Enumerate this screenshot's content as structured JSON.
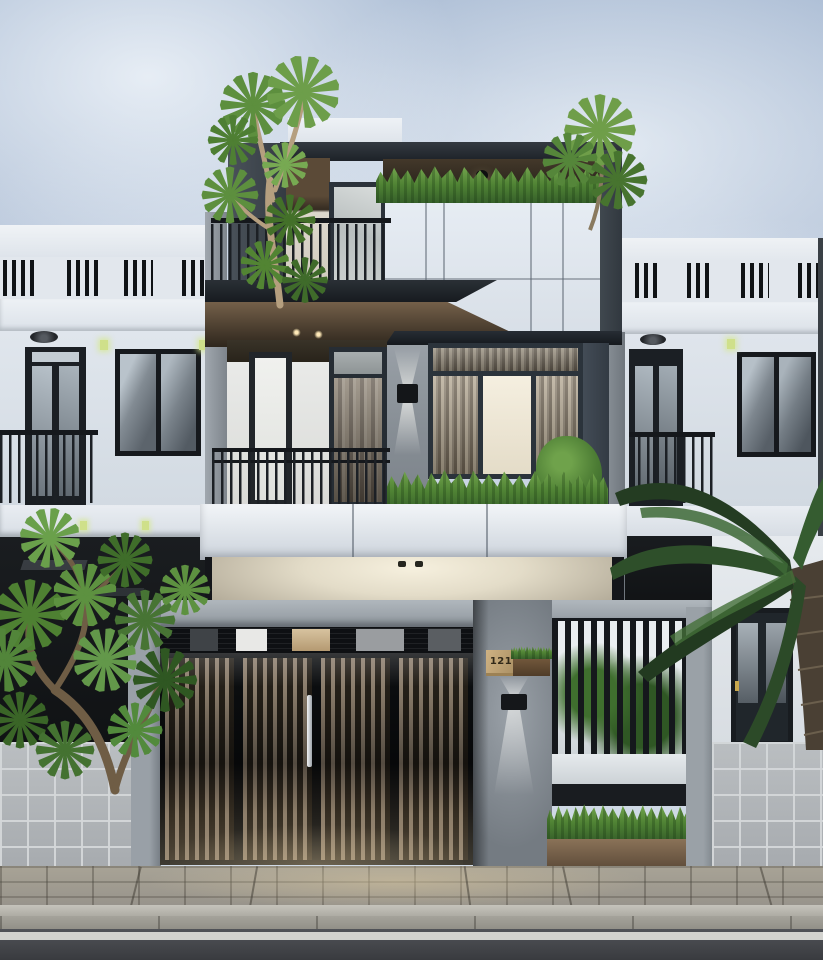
{
  "scene": {
    "type": "3d architectural render",
    "description": "Street elevation of a modern three-storey townhouse with charcoal-framed glazing, stacked balconies, a slatted timber driveway gate, concrete fence piers, rooftop and balcony planters, tropical trees, flanked by two white neighbouring houses beneath a soft cloudy sky, with a paved sidewalk, curb and asphalt road with a single white line in the foreground.",
    "road_marking": "single white edge line"
  },
  "house": {
    "number": "121",
    "storeys": "3"
  },
  "palette": {
    "sky_blue": "#b7c7db",
    "cloud_white": "#e3e9f0",
    "facade_white": "#e6ecf2",
    "frame_charcoal": "#262d34",
    "soffit_brown": "#6b5945",
    "carport_cream": "#efe8d6",
    "concrete_grey": "#8d949b",
    "gate_wood": "#8b7d6c",
    "stone_block": "#b6babd",
    "foliage_green": "#558737",
    "palm_dark_green": "#2c4a28",
    "number_plaque_wood": "#c2a577",
    "asphalt": "#45474b",
    "lane_line_white": "#d9d9d5",
    "accent_light_green": "#cfe08a"
  }
}
